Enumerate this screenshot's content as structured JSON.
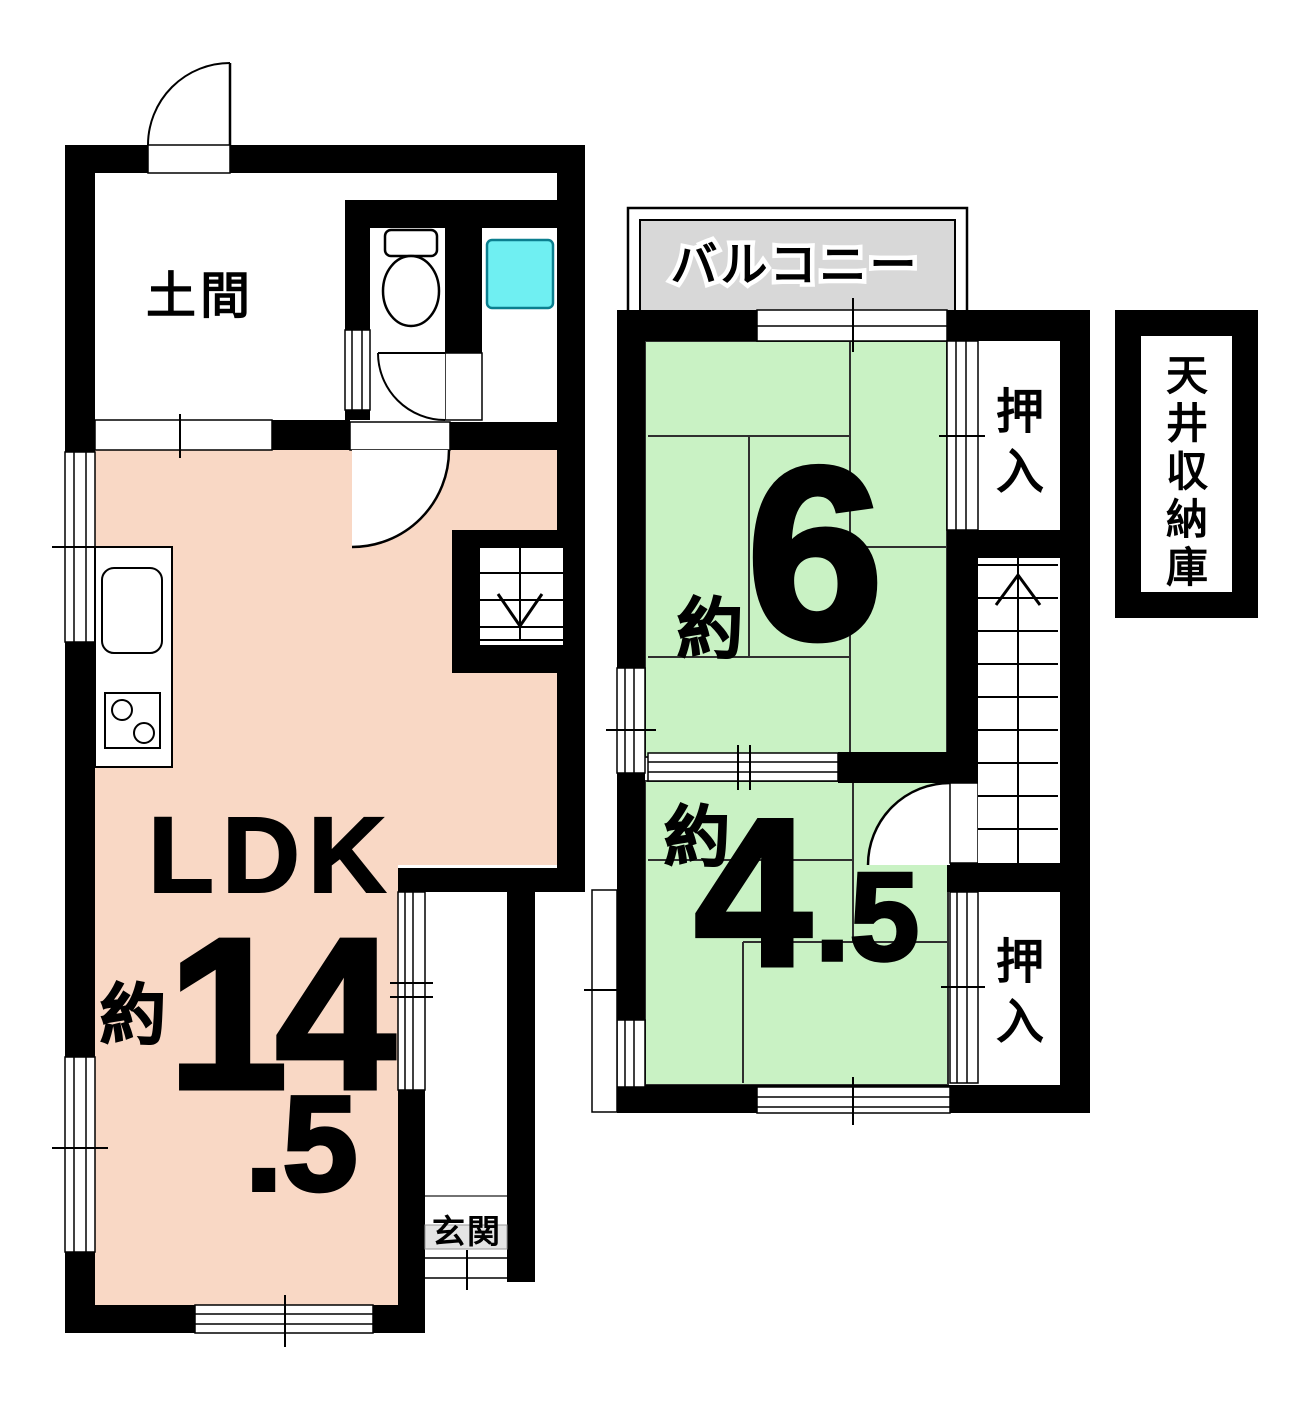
{
  "colors": {
    "wall": "#000000",
    "ldk_fill": "#F9D8C5",
    "tatami_fill": "#C9F2C4",
    "balcony_fill": "#D8D8D8",
    "bath_fill": "#6FEFF2",
    "bath_border": "#0B7F8F",
    "genkan_mat": "#E4E4E4"
  },
  "floor1": {
    "doma_label": "土間",
    "ldk_label": "LDK",
    "ldk_approx": "約",
    "ldk_value": "14",
    "ldk_decimal": ".5",
    "genkan_label": "玄関"
  },
  "floor2": {
    "balcony_label": "バルコニー",
    "room6_approx": "約",
    "room6_value": "6",
    "room45_approx": "約",
    "room45_value": "4",
    "room45_decimal": ".5",
    "closet_upper_label": "押入",
    "closet_lower_label": "押入",
    "ceiling_storage_label": "天井収納庫"
  },
  "icons": {
    "entrance_door": "quarter-arc-door",
    "interior_door": "quarter-arc-door",
    "toilet": "toilet-plan-symbol",
    "bathtub": "bathtub-square",
    "kitchen_sink": "sink-basin",
    "stove": "two-burner-stove",
    "stairs_down_arrow": "down-arrow",
    "stairs_up_arrow": "up-chevron"
  }
}
